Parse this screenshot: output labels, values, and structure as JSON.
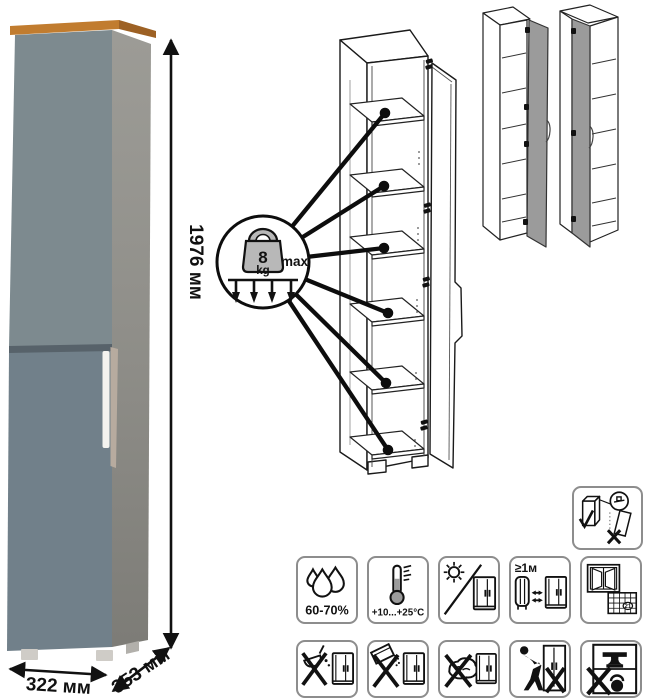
{
  "photo": {
    "height_label": "1976 мм",
    "width_label": "322 мм",
    "depth_label": "353 мм"
  },
  "callout": {
    "weight_value": "8",
    "weight_unit": "kg",
    "max_label": "max"
  },
  "icons": {
    "humidity_label": "60-70%",
    "temperature_label": "+10...+25°C",
    "heat_distance_label": "≥1м",
    "calendar_day": "21"
  },
  "icon_names": {
    "row1": [
      "humidity-icon",
      "temperature-icon",
      "no-direct-sunlight-icon",
      "heat-distance-icon",
      "ventilation-calendar-icon"
    ],
    "row2": [
      "no-aggressive-liquids-icon",
      "no-abrasive-powder-icon",
      "no-wet-cloth-icon",
      "no-pushing-icon",
      "no-overload-icon"
    ],
    "standalone": "anti-tip-secure-to-wall-icon",
    "callout": "weight-limit-icon"
  },
  "colors": {
    "door_upper": "#7d8a8f",
    "door_lower": "#71808a",
    "side_panel": "#91908a",
    "top_wood": "#c17c2f",
    "top_wood_dark": "#9d6124",
    "handle": "#f4f3ef",
    "door_edge_strip": "#b7ab9f",
    "feet": "#cfccc7",
    "line_art": "#1a1a1a",
    "tile_border": "#8d8d8d",
    "variant_door": "#9b9b9b",
    "weight_fill": "#b8b8b8"
  }
}
